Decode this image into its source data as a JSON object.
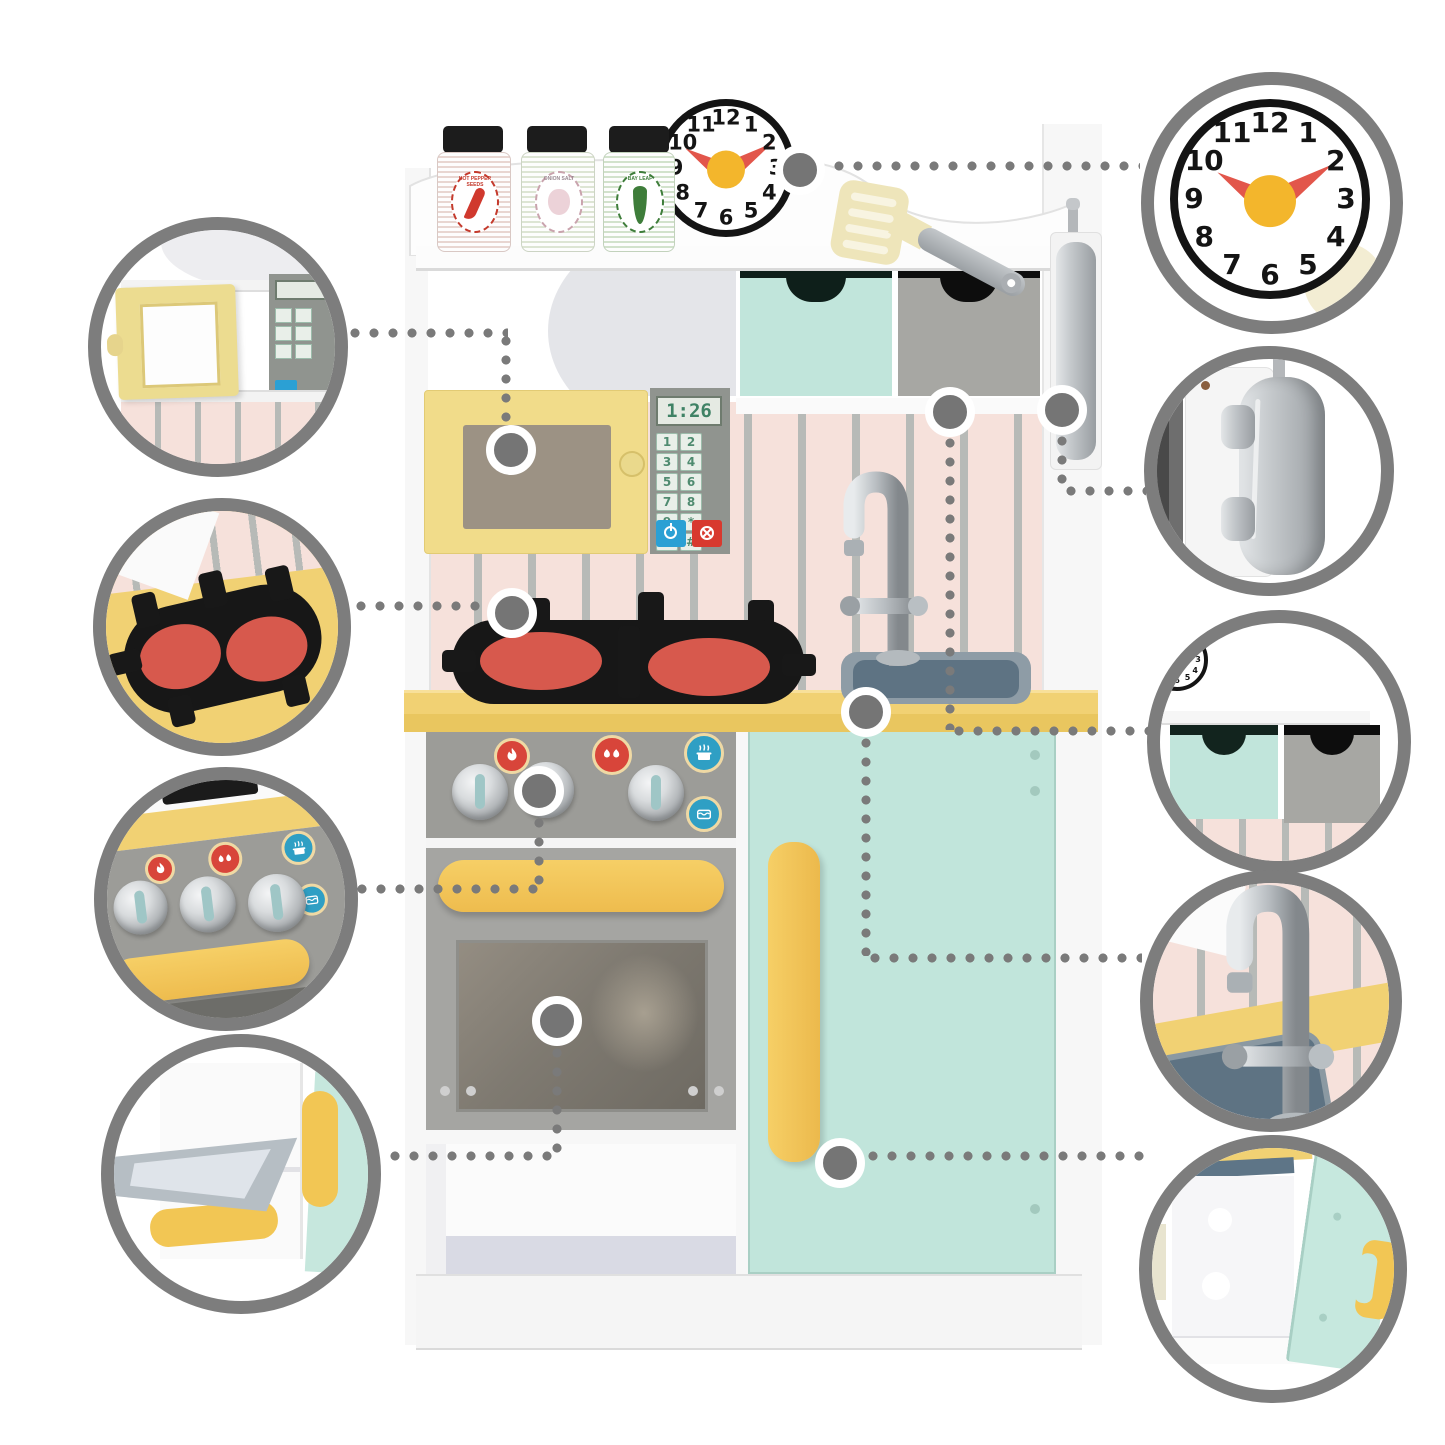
{
  "diagram": {
    "subject": "wooden toy play kitchen with feature callouts",
    "connector_style": "dotted",
    "connector_color": "#7a7a7a",
    "callout_ring_color": "#7d7d7d"
  },
  "clock": {
    "numerals": [
      "12",
      "1",
      "2",
      "3",
      "4",
      "5",
      "6",
      "7",
      "8",
      "9",
      "10",
      "11"
    ],
    "hour_hand_at": "10",
    "minute_hand_at": "2",
    "hand_color": "#e2564b",
    "pivot_color": "#f3b62c"
  },
  "microwave": {
    "display": "1:26",
    "keys": [
      "1",
      "2",
      "3",
      "4",
      "5",
      "6",
      "7",
      "8",
      "9",
      "*",
      "0",
      "#"
    ],
    "start_icon": "power-icon",
    "cancel_icon": "cancel-icon"
  },
  "spice_jars": [
    {
      "label": "HOT PEPPER SEEDS",
      "icon": "chili-pepper-icon",
      "accent": "#c43a2c"
    },
    {
      "label": "ONION SALT",
      "icon": "garlic-icon",
      "accent": "#8aa27c"
    },
    {
      "label": "BAY LEAF",
      "icon": "bay-leaf-icon",
      "accent": "#3e7d3a"
    }
  ],
  "stove_icons": [
    "flame-icon",
    "double-flame-icon",
    "steam-pot-icon",
    "boiling-pot-icon"
  ],
  "callouts": {
    "left": [
      "microwave-door-open",
      "stove-burners",
      "control-knobs-panel",
      "oven-door-open"
    ],
    "right": [
      "play-clock",
      "toy-phone",
      "storage-drawers",
      "sink-and-faucet",
      "cabinet-door-open"
    ]
  },
  "colors": {
    "mint": "#c1e5db",
    "door_yellow": "#f1dc8a",
    "counter_yellow": "#f1d173",
    "handle_yellow": "#f2c654",
    "backsplash_pink": "#f6e1db",
    "stripe_grey": "#b7bab7",
    "drawer_grey": "#a7a7a3",
    "oven_grey": "#a5a5a2",
    "panel_grey": "#9c9c98",
    "burner_red": "#d7594d",
    "sink_grey_blue": "#5e7383",
    "silver": "#b9bdc0"
  }
}
